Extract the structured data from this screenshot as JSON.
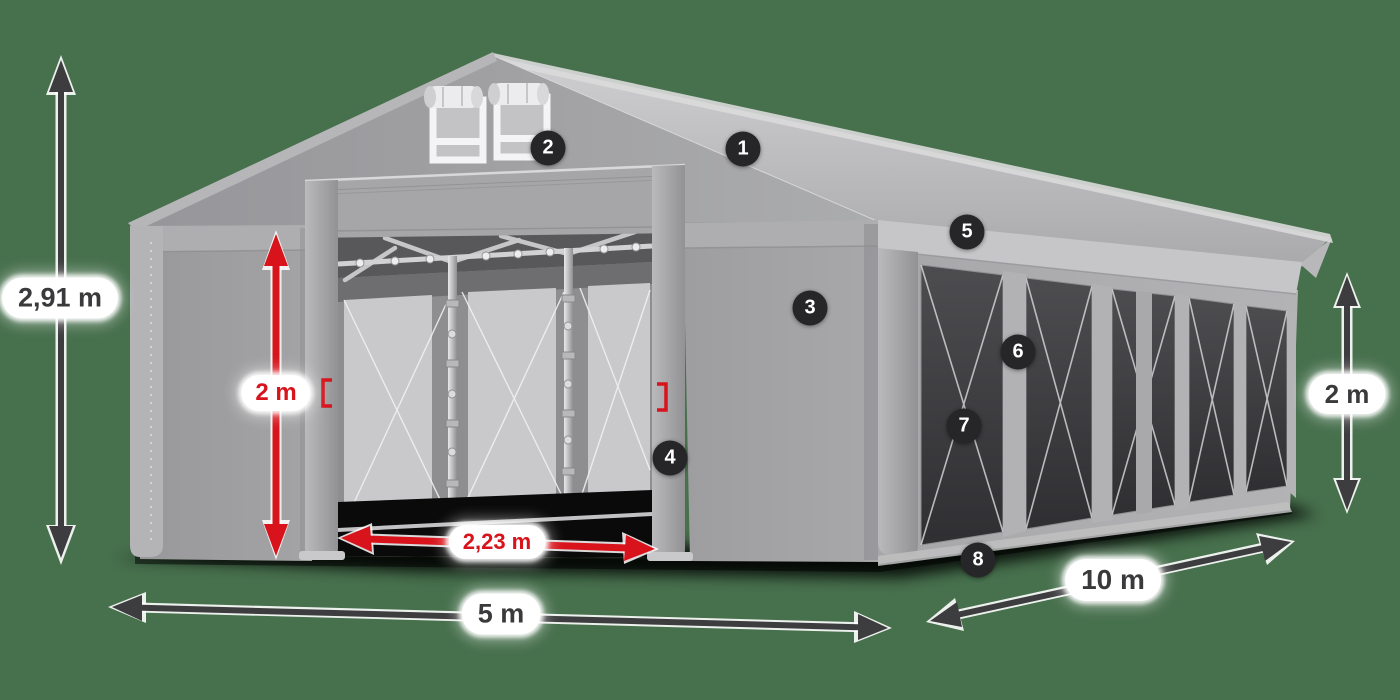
{
  "diagram": {
    "subject": "party-tent-with-dimensions",
    "background_color": "#47704d",
    "dimension_labels": {
      "total_height": "2,91 m",
      "door_height": "2 m",
      "door_width": "2,23 m",
      "front_width": "5 m",
      "side_length": "10 m",
      "side_wall_height": "2 m"
    },
    "callout_numbers": {
      "c1": "1",
      "c2": "2",
      "c3": "3",
      "c4": "4",
      "c5": "5",
      "c6": "6",
      "c7": "7",
      "c8": "8"
    },
    "colors": {
      "background": "#47704d",
      "dimension_red": "#d8131b",
      "dimension_dark": "#3d3d3f",
      "callout_background": "#262628",
      "callout_number": "#ffffff",
      "label_pill_background": "#ffffff",
      "label_text_dark": "#3a3a3c",
      "tent_fabric_gray": "#a5a5a7",
      "roof_light_gray": "#c6c6c8",
      "window_tint": "#3f3f42"
    }
  }
}
